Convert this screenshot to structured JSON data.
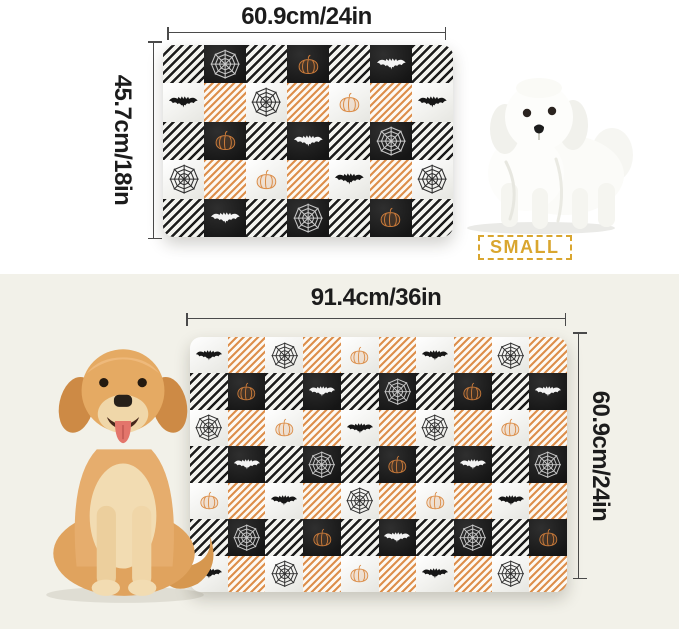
{
  "colors": {
    "background_top": "#ffffff",
    "background_bottom": "#f2f1e9",
    "accent_gold": "#d9a62f",
    "plaid_orange": "#dd8f4c",
    "plaid_black": "#1b1b1b",
    "dimension_line": "#4a4a4a",
    "label_text": "#1c1c1c"
  },
  "motifs": {
    "bat": "bat-icon",
    "web": "spider-web-icon",
    "pumpkin": "pumpkin-icon"
  },
  "sections": {
    "small": {
      "width_label": "60.9cm/24in",
      "height_label": "45.7cm/18in",
      "size_label": "SMALL",
      "dog": "maltese-puppy-photo",
      "grid": {
        "cols": 7,
        "rows": [
          [
            "stripe-black",
            "black:web",
            "stripe-black",
            "black:pumpkin",
            "stripe-black",
            "black:bat",
            "stripe-black"
          ],
          [
            "white:bat",
            "stripe-orange",
            "white:web",
            "stripe-orange",
            "white:pumpkin",
            "stripe-orange",
            "white:bat"
          ],
          [
            "stripe-black",
            "black:pumpkin",
            "stripe-black",
            "black:bat",
            "stripe-black",
            "black:web",
            "stripe-black"
          ],
          [
            "white:web",
            "stripe-orange",
            "white:pumpkin",
            "stripe-orange",
            "white:bat",
            "stripe-orange",
            "white:web"
          ],
          [
            "stripe-black",
            "black:bat",
            "stripe-black",
            "black:web",
            "stripe-black",
            "black:pumpkin",
            "stripe-black"
          ]
        ]
      }
    },
    "medium": {
      "width_label": "91.4cm/36in",
      "height_label": "60.9cm/24in",
      "size_label": "MEDIUM",
      "dog": "golden-retriever-photo",
      "grid": {
        "cols": 10,
        "rows": [
          [
            "white:bat",
            "stripe-orange",
            "white:web",
            "stripe-orange",
            "white:pumpkin",
            "stripe-orange",
            "white:bat",
            "stripe-orange",
            "white:web",
            "stripe-orange"
          ],
          [
            "stripe-black",
            "black:pumpkin",
            "stripe-black",
            "black:bat",
            "stripe-black",
            "black:web",
            "stripe-black",
            "black:pumpkin",
            "stripe-black",
            "black:bat"
          ],
          [
            "white:web",
            "stripe-orange",
            "white:pumpkin",
            "stripe-orange",
            "white:bat",
            "stripe-orange",
            "white:web",
            "stripe-orange",
            "white:pumpkin",
            "stripe-orange"
          ],
          [
            "stripe-black",
            "black:bat",
            "stripe-black",
            "black:web",
            "stripe-black",
            "black:pumpkin",
            "stripe-black",
            "black:bat",
            "stripe-black",
            "black:web"
          ],
          [
            "white:pumpkin",
            "stripe-orange",
            "white:bat",
            "stripe-orange",
            "white:web",
            "stripe-orange",
            "white:pumpkin",
            "stripe-orange",
            "white:bat",
            "stripe-orange"
          ],
          [
            "stripe-black",
            "black:web",
            "stripe-black",
            "black:pumpkin",
            "stripe-black",
            "black:bat",
            "stripe-black",
            "black:web",
            "stripe-black",
            "black:pumpkin"
          ],
          [
            "white:bat",
            "stripe-orange",
            "white:web",
            "stripe-orange",
            "white:pumpkin",
            "stripe-orange",
            "white:bat",
            "stripe-orange",
            "white:web",
            "stripe-orange"
          ]
        ]
      }
    }
  }
}
